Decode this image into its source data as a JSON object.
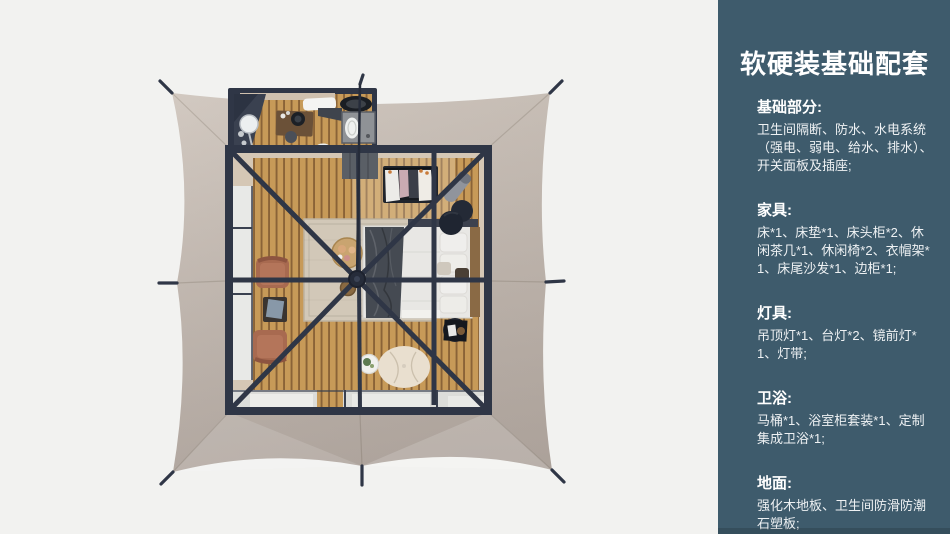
{
  "sidebar": {
    "title": "软硬装基础配套",
    "sections": [
      {
        "heading": "基础部分:",
        "body": "卫生间隔断、防水、水电系统（强电、弱电、给水、排水）、开关面板及插座;"
      },
      {
        "heading": "家具:",
        "body": "床*1、床垫*1、床头柜*2、休闲茶几*1、休闲椅*2、衣帽架*1、床尾沙发*1、边柜*1;"
      },
      {
        "heading": "灯具:",
        "body": "吊顶灯*1、台灯*2、镜前灯*1、灯带;"
      },
      {
        "heading": "卫浴:",
        "body": "马桶*1、浴室柜套装*1、定制集成卫浴*1;"
      },
      {
        "heading": "地面:",
        "body": "强化木地板、卫生间防滑防潮石塑板;"
      }
    ]
  },
  "colors": {
    "bg": "#f2f2f0",
    "panel-bg": "#3e5b6c",
    "panel-text": "#f2f5f6",
    "canopy": "#c4b9b0",
    "canopy-deep": "#b6aba3",
    "frame": "#2f3646",
    "floor": "#c79a58",
    "floor-gap": "#8a6337",
    "wall": "#d5c7b5",
    "glass": "#dcddda",
    "rug": "#d2c8b8",
    "bed": "#e8e7e4",
    "blanket": "#454a52",
    "chair": "#b4755a",
    "pouf": "#e9dfcf"
  }
}
